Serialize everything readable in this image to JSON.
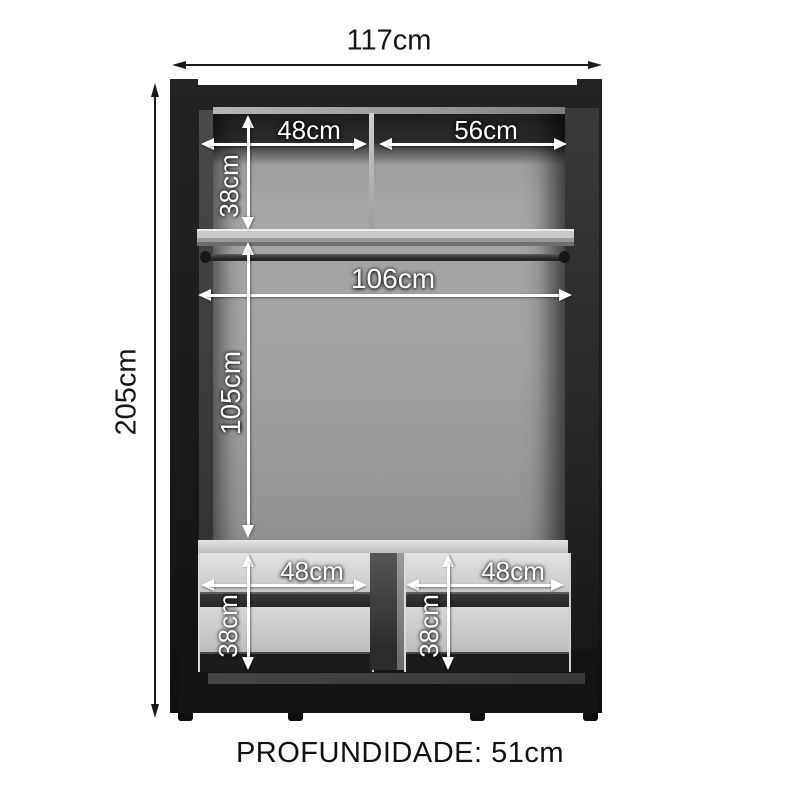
{
  "product_diagram": {
    "type": "wardrobe-internal-dimensions",
    "outer": {
      "width_label": "117cm",
      "height_label": "205cm"
    },
    "top_section": {
      "left_width_label": "48cm",
      "right_width_label": "56cm",
      "height_label": "38cm"
    },
    "hanging_section": {
      "rod_width_label": "106cm",
      "height_label": "105cm"
    },
    "drawers": {
      "left_width_label": "48cm",
      "right_width_label": "48cm",
      "left_height_label": "38cm",
      "right_height_label": "38cm"
    },
    "footer_label": "PROFUNDIDADE: 51cm",
    "colors": {
      "frame": "#1b1b1b",
      "interior": "#9e9e9e",
      "shelf": "#cccccc",
      "drawer_front": "#d8d8d8",
      "dimension_inner": "#ffffff",
      "dimension_outer": "#1a1a1a",
      "footer_text": "#111111",
      "background": "#ffffff"
    }
  }
}
